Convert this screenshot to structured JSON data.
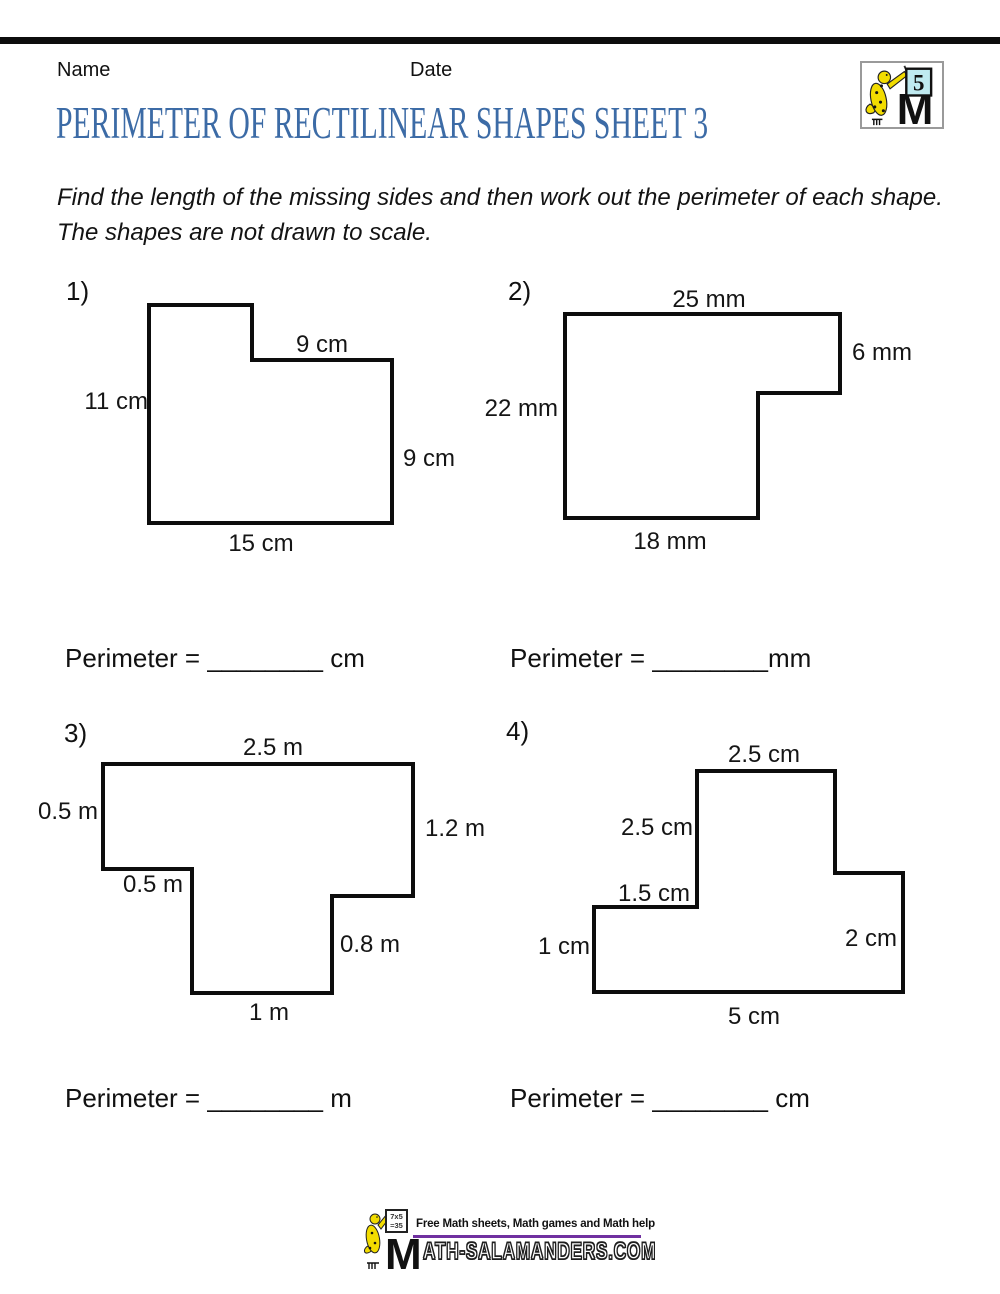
{
  "page": {
    "title": "PERIMETER OF RECTILINEAR SHAPES SHEET 3"
  },
  "header": {
    "name_label": "Name",
    "date_label": "Date",
    "badge_number": "5"
  },
  "instructions": {
    "line1": "Find the length of the missing sides and then work out the perimeter of each shape.",
    "line2": "The shapes are not drawn to scale."
  },
  "problems": [
    {
      "number": "1)",
      "unit": "cm",
      "labels": {
        "top_inner": "9 cm",
        "left": "11 cm",
        "right": "9 cm",
        "bottom": "15 cm"
      },
      "answer": "Perimeter = ________ cm"
    },
    {
      "number": "2)",
      "unit": "mm",
      "labels": {
        "top": "25 mm",
        "right": "6 mm",
        "left": "22 mm",
        "bottom": "18 mm"
      },
      "answer": "Perimeter = ________mm"
    },
    {
      "number": "3)",
      "unit": "m",
      "labels": {
        "top": "2.5 m",
        "left": "0.5 m",
        "right": "1.2 m",
        "step": "0.5 m",
        "inner_right": "0.8 m",
        "bottom": "1 m"
      },
      "answer": "Perimeter = ________ m"
    },
    {
      "number": "4)",
      "unit": "cm",
      "labels": {
        "top": "2.5 cm",
        "upper_left": "2.5 cm",
        "step_left": "1.5 cm",
        "left": "1 cm",
        "right": "2 cm",
        "bottom": "5 cm"
      },
      "answer": "Perimeter = ________ cm"
    }
  ],
  "footer": {
    "tagline": "Free Math sheets, Math games and Math help",
    "site_rest": "ATH-SALAMANDERS.COM",
    "board_line1": "7x5",
    "board_line2": "=35"
  },
  "colors": {
    "title-blue": "#3c6ba6",
    "accent-purple": "#7030a0",
    "board-cyan": "#bfeaf0",
    "salamander-yellow": "#f2dc00"
  }
}
